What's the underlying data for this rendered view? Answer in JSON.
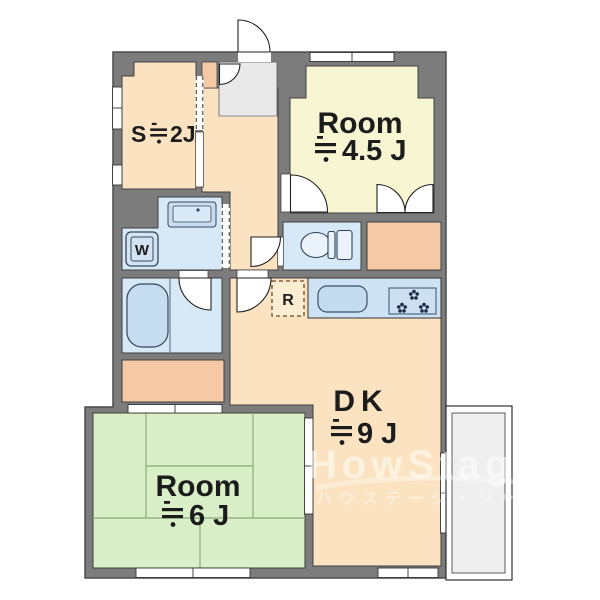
{
  "floorplan": {
    "rooms": {
      "service": {
        "label": "S",
        "size_text": "≒2J",
        "size_display": "2J",
        "color": "#fbe3c2"
      },
      "western_room": {
        "label": "Room",
        "size_text": "≒4.5J",
        "size_display": "4.5 J",
        "color": "#f8f6d2"
      },
      "dining_kitchen": {
        "label": "DK",
        "size_text": "≒9J",
        "size_display": "9 J",
        "color": "#fbe3c2"
      },
      "tatami_room": {
        "label": "Room",
        "size_text": "≒6J",
        "size_display": "6 J",
        "color": "#d9efc7"
      }
    },
    "fixtures": {
      "washing_machine_label": "W",
      "refrigerator_label": "R"
    },
    "watermark": {
      "latin": "HowStage",
      "kana": "ハウステージ・ジャパン"
    },
    "colors": {
      "wall": "#7c7c7c",
      "wet_area": "#d7e8f6",
      "closet": "#f5c9a6",
      "entry_tile": "#e9e9e9",
      "balcony": "#efefef",
      "outline": "#3f3f3f"
    }
  }
}
